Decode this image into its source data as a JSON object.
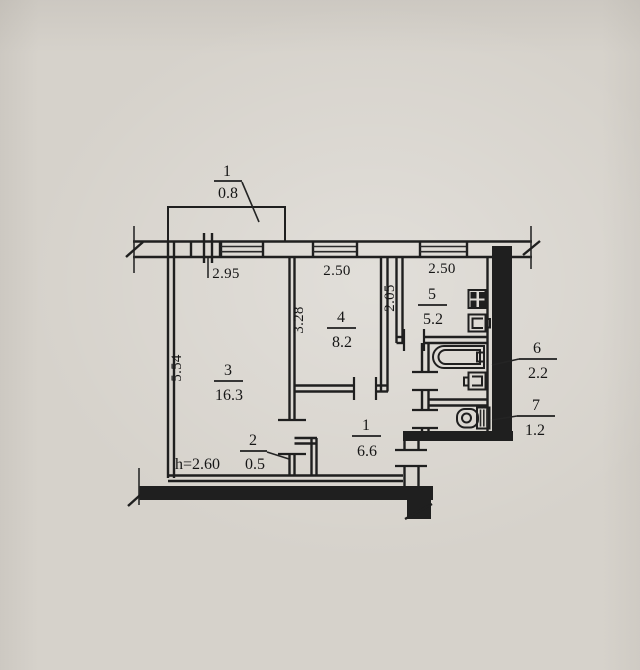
{
  "rooms": {
    "balcony": {
      "number": "1",
      "area": "0.8"
    },
    "living_room": {
      "number": "3",
      "area": "16.3"
    },
    "bedroom": {
      "number": "4",
      "area": "8.2"
    },
    "kitchen": {
      "number": "5",
      "area": "5.2"
    },
    "bathroom": {
      "number": "6",
      "area": "2.2"
    },
    "toilet": {
      "number": "7",
      "area": "1.2"
    },
    "hallway": {
      "number": "1",
      "area": "6.6"
    },
    "closet": {
      "number": "2",
      "area": "0.5"
    }
  },
  "dimensions": {
    "living_width": "2.95",
    "bedroom_width": "2.50",
    "kitchen_width": "2.50",
    "living_depth": "5.54",
    "bedroom_depth": "3.28",
    "kitchen_depth": "2.05",
    "ceiling_height": "h=2.60"
  },
  "colors": {
    "paper": "#d6d2cb",
    "ink": "#1f1f1f"
  }
}
